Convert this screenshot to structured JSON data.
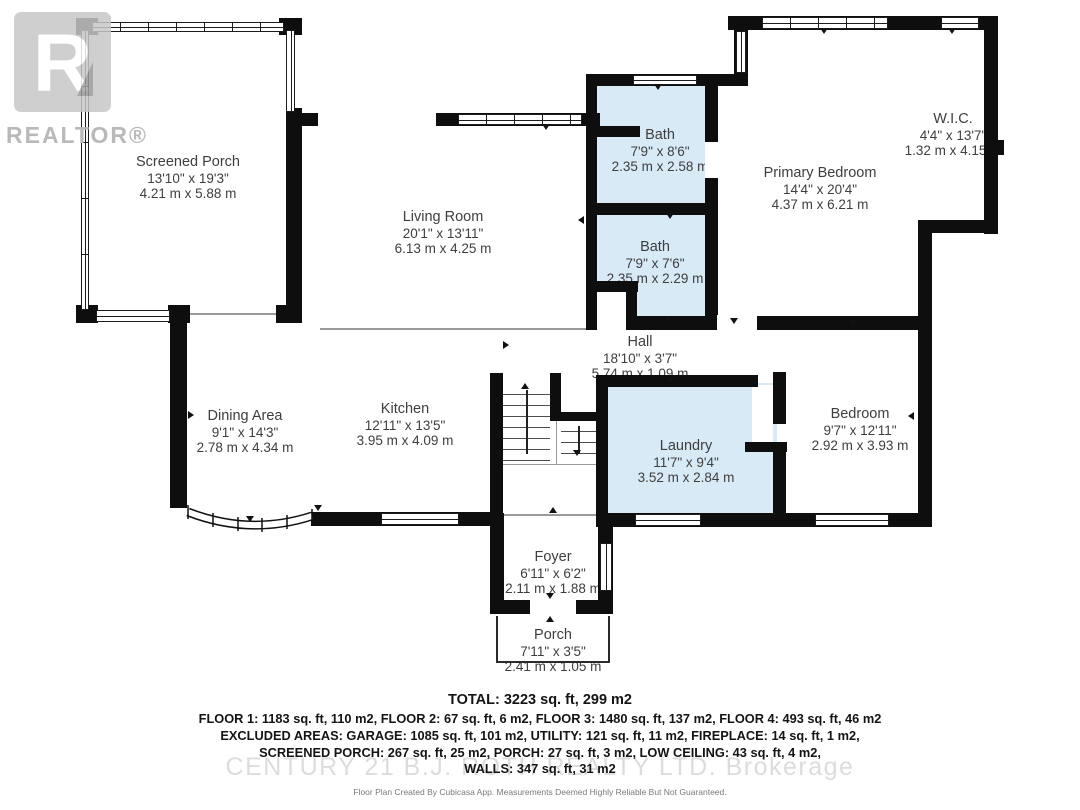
{
  "watermarks": {
    "realtor_letter": "R",
    "realtor_text": "REALTOR®",
    "brokerage": "CENTURY 21 B.J. ROTH REALTY LTD.  Brokerage"
  },
  "rooms": {
    "screened_porch": {
      "name": "Screened Porch",
      "imperial": "13'10\" x 19'3\"",
      "metric": "4.21 m x 5.88 m"
    },
    "living_room": {
      "name": "Living Room",
      "imperial": "20'1\" x 13'11\"",
      "metric": "6.13 m x 4.25 m"
    },
    "bath_upper": {
      "name": "Bath",
      "imperial": "7'9\" x 8'6\"",
      "metric": "2.35 m x 2.58 m"
    },
    "bath_lower": {
      "name": "Bath",
      "imperial": "7'9\" x 7'6\"",
      "metric": "2.35 m x 2.29 m"
    },
    "primary_bedroom": {
      "name": "Primary Bedroom",
      "imperial": "14'4\" x 20'4\"",
      "metric": "4.37 m x 6.21 m"
    },
    "wic": {
      "name": "W.I.C.",
      "imperial": "4'4\" x 13'7\"",
      "metric": "1.32 m x 4.15 m"
    },
    "hall": {
      "name": "Hall",
      "imperial": "18'10\" x 3'7\"",
      "metric": "5.74 m x 1.09 m"
    },
    "dining_area": {
      "name": "Dining Area",
      "imperial": "9'1\" x 14'3\"",
      "metric": "2.78 m x 4.34 m"
    },
    "kitchen": {
      "name": "Kitchen",
      "imperial": "12'11\" x 13'5\"",
      "metric": "3.95 m x 4.09 m"
    },
    "laundry": {
      "name": "Laundry",
      "imperial": "11'7\" x 9'4\"",
      "metric": "3.52 m x 2.84 m"
    },
    "bedroom": {
      "name": "Bedroom",
      "imperial": "9'7\" x 12'11\"",
      "metric": "2.92 m x 3.93 m"
    },
    "foyer": {
      "name": "Foyer",
      "imperial": "6'11\" x 6'2\"",
      "metric": "2.11 m x 1.88 m"
    },
    "porch": {
      "name": "Porch",
      "imperial": "7'11\" x 3'5\"",
      "metric": "2.41 m x 1.05 m"
    }
  },
  "summary": {
    "total": "TOTAL: 3223 sq. ft, 299 m2",
    "floors": "FLOOR 1: 1183 sq. ft, 110 m2, FLOOR 2: 67 sq. ft, 6 m2, FLOOR 3: 1480 sq. ft, 137 m2, FLOOR 4: 493 sq. ft, 46 m2",
    "excluded1": "EXCLUDED AREAS: GARAGE: 1085 sq. ft, 101 m2, UTILITY: 121 sq. ft, 11 m2, FIREPLACE: 14 sq. ft, 1 m2,",
    "excluded2": "SCREENED PORCH: 267 sq. ft, 25 m2, PORCH: 27 sq. ft, 3 m2, LOW CEILING: 43 sq. ft, 4 m2,",
    "walls": "WALLS: 347 sq. ft, 31 m2"
  },
  "disclaimer": "Floor Plan Created By Cubicasa App. Measurements Deemed Highly Reliable But Not Guaranteed.",
  "colors": {
    "wall": "#0e0e0e",
    "room_fill_blue": "#d9eaf7",
    "label_text": "#3e3e3e",
    "watermark_gray": "#c7c7c7"
  }
}
